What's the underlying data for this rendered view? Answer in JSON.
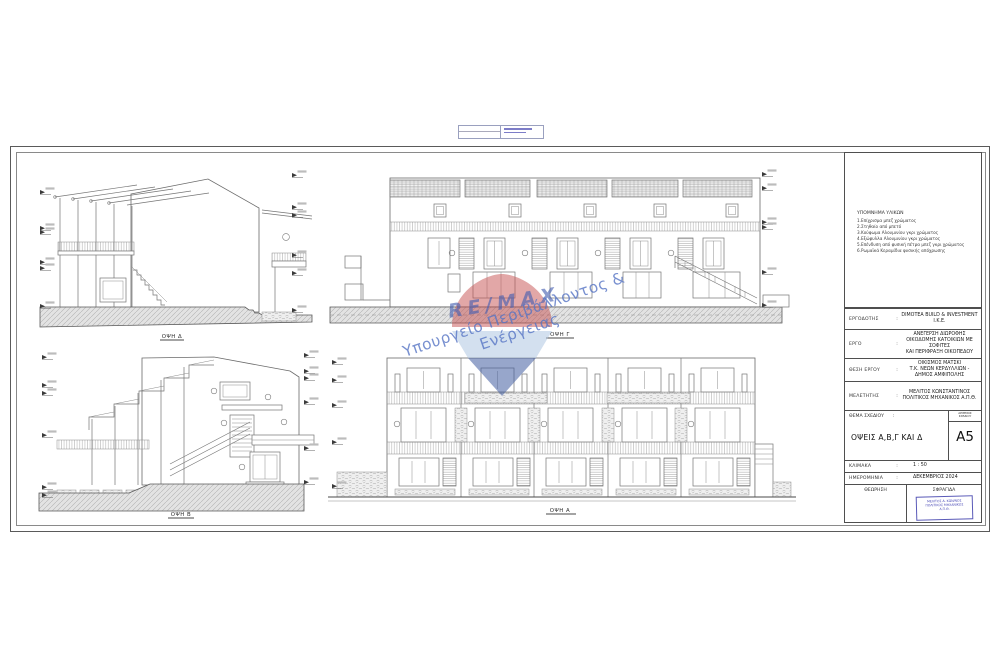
{
  "legend": {
    "title": "ΥΠΟΜΝΗΜΑ ΥΛΙΚΩΝ",
    "items": [
      "1.Επίχρισμα μπεζ χρώματος",
      "2.Στηθαίο από μπετό",
      "3.Κούφωμα Αλουμινίου γκρι χρώματος",
      "4.Εξώφυλλα Αλουμινίου γκρι χρώματος",
      "5.Επένδυση από φυσική πέτρα μπεζ γκρι χρώματος",
      "6.Ρωμαϊκά Κεραμίδια φυσικής απόχρωσης"
    ]
  },
  "titleblock": {
    "rows": [
      {
        "label": "ΕΡΓΟΔΟΤΗΣ",
        "colon": ":",
        "value": "DIMOTEA BUILD & INVESTMENT Ι.Κ.Ε."
      },
      {
        "label": "ΕΡΓΟ",
        "colon": ":",
        "value": "ΑΝΕΓΕΡΣΗ ΔΙΩΡΟΦΗΣ\nΟΙΚΟΔΟΜΗΣ ΚΑΤΟΙΚΙΩΝ ΜΕ ΣΟΦΙΤΕΣ\nΚΑΙ ΠΕΡΙΦΡΑΞΗ ΟΙΚΟΠΕΔΟΥ"
      },
      {
        "label": "ΘΕΣΗ ΕΡΓΟΥ",
        "colon": ":",
        "value": "ΟΙΚΙΣΜΟΣ ΜΑΤΣΚΙ\nΤ.Κ. ΝΕΩΝ ΚΕΡΔΥΛΛΙΩΝ - ΔΗΜΟΣ ΑΜΦΙΠΟΛΗΣ"
      },
      {
        "label": "ΜΕΛΕΤΗΤΗΣ",
        "colon": ":",
        "value": "ΜΕΛΙΤΟΣ ΚΩΝΣΤΑΝΤΙΝΟΣ\nΠΟΛΙΤΙΚΟΣ ΜΗΧΑΝΙΚΟΣ Α.Π.Θ."
      }
    ],
    "subject_label": "ΘΕΜΑ ΣΧΕΔΙΟΥ",
    "subject_colon": ":",
    "subject": "ΟΨΕΙΣ Α,Β,Γ ΚΑΙ Δ",
    "sheet_no_caption": "ΑΡΙΘΜΟΣ\nΣΧΕΔΙΟΥ",
    "sheet_no": "A5",
    "scale_label": "ΚΛΙΜΑΚΑ",
    "scale_colon": ":",
    "scale": "1 : 50",
    "date_label": "ΗΜΕΡΟΜΗΝΙΑ",
    "date_colon": ":",
    "date": "ΔΕΚΕΜΒΡΙΟΣ 2024",
    "approval_label": "ΘΕΩΡΗΣΗ",
    "stamp_label": "ΣΦΡΑΓΙΔΑ",
    "stamp_text": "ΜΕΛΙΤΟΣ Δ. ΚΩΝ/ΝΟΣ\nΠΟΛΙΤΙΚΟΣ ΜΗΧΑΝΙΚΟΣ\nΑ.Π.Θ."
  },
  "elevations": {
    "d": "ΟΨΗ Δ",
    "c": "ΟΨΗ Γ",
    "b": "ΟΨΗ Β",
    "a": "ΟΨΗ Α"
  },
  "watermark": {
    "brand": "RE/MAX",
    "text": "Υπουργείο Περιβάλλοντος & Ενέργειας",
    "colors": {
      "red": "#c65050",
      "blue": "#425ca0",
      "light_blue": "#afc6e2",
      "text_blue": "#5674c4"
    }
  }
}
